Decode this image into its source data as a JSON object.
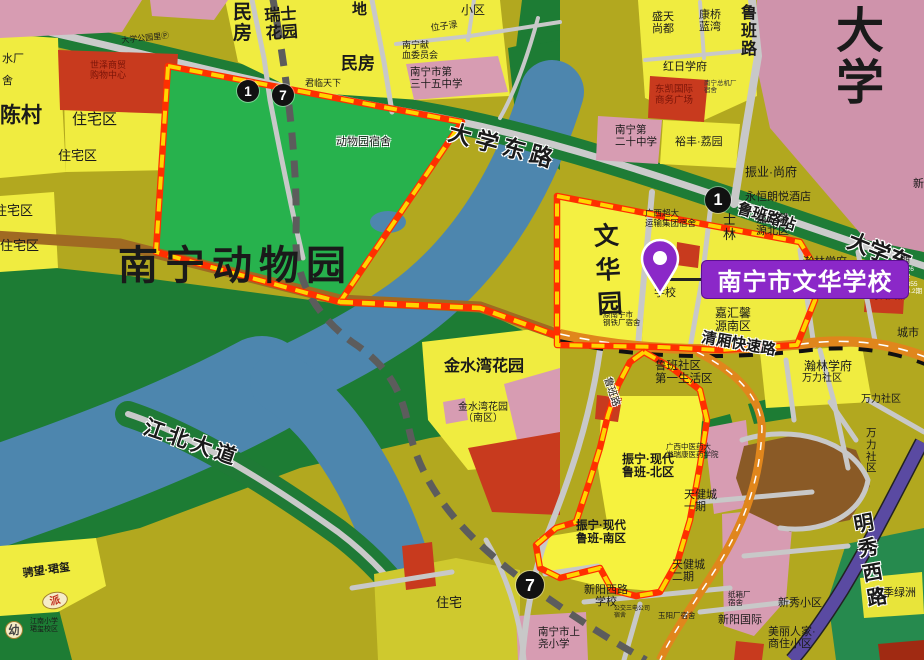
{
  "map": {
    "callout": {
      "text": "南宁市文华学校"
    },
    "colors": {
      "highlight_line": "#ff2f00",
      "highlight_dash": "#ffd400",
      "callout_purple": "#8b28c8",
      "zoo_green": "#27b24d",
      "river_blue": "#4d86ae",
      "expressway_orange": "#e0861c",
      "metro_gray": "#5c5c5c",
      "campus_pink": "#cf93ab",
      "block_yellow": "#f0ec40",
      "base_olive": "#b2a81f",
      "vegetation_green": "#1d7c34",
      "purple_road": "#5a4aa2"
    },
    "route_markers": [
      {
        "t": "1",
        "x": 248,
        "y": 91,
        "r": 11
      },
      {
        "t": "7",
        "x": 283,
        "y": 95,
        "r": 11
      },
      {
        "t": "1",
        "x": 718,
        "y": 200,
        "r": 13
      },
      {
        "t": "7",
        "x": 530,
        "y": 585,
        "r": 14
      }
    ],
    "badges": [
      {
        "t": "派",
        "x": 42,
        "y": 592,
        "w": 24,
        "h": 15,
        "fg": "#c23020",
        "rot": -12
      },
      {
        "t": "幼",
        "x": 5,
        "y": 621,
        "w": 16,
        "h": 16,
        "fg": "#444444",
        "rot": 0
      }
    ],
    "labels": [
      {
        "n": "minfang-vertical",
        "t": "民\n房",
        "x": 233,
        "y": 2,
        "s": 19,
        "b": 1
      },
      {
        "n": "ruishi-huayuan",
        "t": "瑞士\n花园",
        "x": 264,
        "y": 8,
        "s": 16,
        "b": 1,
        "r": -4
      },
      {
        "n": "di",
        "t": "地",
        "x": 352,
        "y": 2,
        "s": 15,
        "b": 1
      },
      {
        "n": "xiaoqu",
        "t": "小区",
        "x": 461,
        "y": 4,
        "s": 12
      },
      {
        "n": "minfang",
        "t": "民房",
        "x": 341,
        "y": 54,
        "s": 17,
        "b": 1
      },
      {
        "n": "weizilu-street",
        "t": "位子渌",
        "x": 430,
        "y": 23,
        "s": 9,
        "r": -8
      },
      {
        "n": "blood-committee",
        "t": "南宁献\n血委员会",
        "x": 402,
        "y": 40,
        "s": 9
      },
      {
        "n": "no35-middle-school",
        "t": "南宁市第\n三十五中学",
        "x": 410,
        "y": 67,
        "s": 10.5
      },
      {
        "n": "junlin-tianxia",
        "t": "君临天下",
        "x": 305,
        "y": 78,
        "s": 9
      },
      {
        "n": "daxue-park-p",
        "t": "大学公园里Ⓟ",
        "x": 121,
        "y": 37,
        "s": 8,
        "r": -6
      },
      {
        "n": "shuichang",
        "t": "水厂",
        "x": 2,
        "y": 53,
        "s": 11
      },
      {
        "n": "she",
        "t": "舍",
        "x": 2,
        "y": 75,
        "s": 11
      },
      {
        "n": "shopping-center",
        "t": "世泽商贸\n购物中心",
        "x": 90,
        "y": 60,
        "s": 9,
        "c": "#7a1408"
      },
      {
        "n": "chencun",
        "t": "陈村",
        "x": 0,
        "y": 104,
        "s": 21,
        "b": 1
      },
      {
        "n": "zhuzhaiqu-1",
        "t": "住宅区",
        "x": 72,
        "y": 112,
        "s": 15
      },
      {
        "n": "zhuzhaiqu-2",
        "t": "住宅区",
        "x": 58,
        "y": 149,
        "s": 13
      },
      {
        "n": "zhuzhaiqu-3",
        "t": "住宅区",
        "x": -6,
        "y": 204,
        "s": 13
      },
      {
        "n": "zhuzhaiqu-4",
        "t": "住宅区",
        "x": 0,
        "y": 239,
        "s": 13
      },
      {
        "n": "lubanlu-vertical",
        "t": "鲁\n班\n路",
        "x": 741,
        "y": 5,
        "s": 16,
        "b": 1
      },
      {
        "n": "shengtian-shangdu",
        "t": "盛天\n尚都",
        "x": 652,
        "y": 11,
        "s": 11
      },
      {
        "n": "kangqiao-lanwan",
        "t": "康桥\n蓝湾",
        "x": 699,
        "y": 9,
        "s": 11
      },
      {
        "n": "daxue-big",
        "t": "大\n学",
        "x": 836,
        "y": 6,
        "s": 48,
        "b": 1,
        "lh": 1.08
      },
      {
        "n": "hongri-xuefu",
        "t": "红日学府",
        "x": 663,
        "y": 61,
        "s": 11
      },
      {
        "n": "dongkai-plaza",
        "t": "东凯国际\n商务广场",
        "x": 655,
        "y": 85,
        "s": 9.5,
        "c": "#7a1408"
      },
      {
        "n": "zongjichang-sushe",
        "t": "南宁总机厂\n宿舍",
        "x": 704,
        "y": 80,
        "s": 6.5,
        "c": "#333333"
      },
      {
        "n": "no20-middle-school",
        "t": "南宁第\n二十中学",
        "x": 615,
        "y": 125,
        "s": 10.5
      },
      {
        "n": "yufeng-liyuan",
        "t": "裕丰·荔园",
        "x": 675,
        "y": 136,
        "s": 11
      },
      {
        "n": "zhenye-shangfu",
        "t": "振业·尚府",
        "x": 745,
        "y": 166,
        "s": 12
      },
      {
        "n": "yongheng-hotel",
        "t": "永恒朗悦酒店",
        "x": 745,
        "y": 191,
        "s": 11
      },
      {
        "n": "lubanlu-station",
        "t": "鲁班路站",
        "x": 740,
        "y": 201,
        "s": 15,
        "b": 1,
        "r": 17,
        "h": 1
      },
      {
        "n": "daxuedonglu-road",
        "t": "大学东路",
        "x": 452,
        "y": 120,
        "s": 23,
        "b": 1,
        "r": 15,
        "h": 1,
        "ls": 5
      },
      {
        "n": "daxuedong-right",
        "t": "大学东",
        "x": 853,
        "y": 229,
        "s": 22,
        "b": 1,
        "r": 22,
        "h": 1
      },
      {
        "n": "zoo-dorm",
        "t": "动物园宿舍",
        "x": 336,
        "y": 136,
        "s": 11,
        "h": 1
      },
      {
        "n": "nanning-zoo",
        "t": "南宁动物园",
        "x": 118,
        "y": 244,
        "s": 40,
        "b": 1,
        "ls": 7
      },
      {
        "n": "wenhuayuan-vertical",
        "t": "文\n华\n园",
        "x": 593,
        "y": 221,
        "s": 25,
        "b": 1,
        "lh": 1.35,
        "r": -3
      },
      {
        "n": "chaoda-dorm",
        "t": "广西超大\n运输集团宿舍",
        "x": 645,
        "y": 209,
        "s": 8.5
      },
      {
        "n": "xuexiao",
        "t": "学校",
        "x": 654,
        "y": 287,
        "s": 11
      },
      {
        "n": "gangtiechang-dorm",
        "t": "原南宁市\n钢铁厂宿舍",
        "x": 603,
        "y": 311,
        "s": 7.5
      },
      {
        "n": "shilin-vertical",
        "t": "士\n林",
        "x": 723,
        "y": 213,
        "s": 13
      },
      {
        "n": "jiahuixin-north",
        "t": "嘉汇馨\n源北区",
        "x": 756,
        "y": 213,
        "s": 11
      },
      {
        "n": "jiahuixin-south",
        "t": "嘉汇馨\n源南区",
        "x": 715,
        "y": 307,
        "s": 12
      },
      {
        "n": "hanlin-xuefu-1",
        "t": "瀚林学府",
        "x": 803,
        "y": 256,
        "s": 11
      },
      {
        "n": "qi",
        "t": "期",
        "x": 900,
        "y": 255,
        "s": 10
      },
      {
        "n": "small-numbers",
        "t": "626\n12\n1355\n64.2期",
        "x": 903,
        "y": 266,
        "s": 6.5,
        "c": "#ffffff"
      },
      {
        "n": "shidai-tianjiao",
        "t": "时代天骄",
        "x": 870,
        "y": 291,
        "s": 9,
        "c": "#7a1408"
      },
      {
        "n": "chengshi",
        "t": "城市",
        "x": 897,
        "y": 327,
        "s": 11
      },
      {
        "n": "qingxiang-expressway",
        "t": "清厢快速路",
        "x": 703,
        "y": 330,
        "s": 15,
        "b": 1,
        "r": 10,
        "h": 1
      },
      {
        "n": "hanlin-xuefu-2",
        "t": "瀚林学府",
        "x": 804,
        "y": 360,
        "s": 12
      },
      {
        "n": "wanli-shequ-1",
        "t": "万力社区",
        "x": 802,
        "y": 373,
        "s": 10
      },
      {
        "n": "wanli-shequ-2",
        "t": "万力社区",
        "x": 861,
        "y": 394,
        "s": 10
      },
      {
        "n": "wanli-shequ-vertical",
        "t": "万\n力\n社\n区",
        "x": 866,
        "y": 428,
        "s": 10.5
      },
      {
        "n": "luban-shequ",
        "t": "鲁班社区\n第一生活区",
        "x": 655,
        "y": 360,
        "s": 11.5
      },
      {
        "n": "lubanlu-south",
        "t": "鲁班路",
        "x": 612,
        "y": 376,
        "s": 10,
        "r": 72,
        "h": 1
      },
      {
        "n": "zhenning-north",
        "t": "振宁·现代\n鲁班-北区",
        "x": 622,
        "y": 453,
        "s": 12,
        "b": 1
      },
      {
        "n": "zhongyiyao-college",
        "t": "广西中医药大\n学瑞康医药学院",
        "x": 666,
        "y": 443,
        "s": 7.5
      },
      {
        "n": "tianjiancheng-1",
        "t": "天健城\n一期",
        "x": 684,
        "y": 489,
        "s": 11
      },
      {
        "n": "zhenning-south",
        "t": "振宁·现代\n鲁班-南区",
        "x": 576,
        "y": 520,
        "s": 11.5,
        "b": 1
      },
      {
        "n": "tianjiancheng-2",
        "t": "天健城\n二期",
        "x": 672,
        "y": 559,
        "s": 11
      },
      {
        "n": "mingxiuxilu-road",
        "t": "明\n秀\n西\n路",
        "x": 852,
        "y": 514,
        "s": 20,
        "b": 1,
        "r": -10,
        "h": 1,
        "lh": 1.25
      },
      {
        "n": "siji-lvzhou",
        "t": "四季绿洲",
        "x": 872,
        "y": 587,
        "s": 11
      },
      {
        "n": "xinxiu-xiaoqu",
        "t": "新秀小区",
        "x": 778,
        "y": 597,
        "s": 11
      },
      {
        "n": "zhixiangchang-dorm",
        "t": "纸箱厂\n宿舍",
        "x": 728,
        "y": 591,
        "s": 7.5
      },
      {
        "n": "yuyangchang-dorm",
        "t": "玉阳厂宿舍",
        "x": 658,
        "y": 612,
        "s": 7.5
      },
      {
        "n": "xinyang-guoji",
        "t": "新阳国际",
        "x": 718,
        "y": 614,
        "s": 11
      },
      {
        "n": "meili-renjia",
        "t": "美丽人家·\n商住小区",
        "x": 768,
        "y": 626,
        "s": 11
      },
      {
        "n": "xinyangxilu-school",
        "t": "新阳西路\n学校",
        "x": 584,
        "y": 584,
        "s": 11,
        "ta": "center"
      },
      {
        "n": "gongjiao-dorm",
        "t": "公交三电公司\n宿舍",
        "x": 614,
        "y": 606,
        "s": 6
      },
      {
        "n": "shangyao-primary",
        "t": "南宁市上\n尧小学",
        "x": 538,
        "y": 627,
        "s": 10.5
      },
      {
        "n": "zhuzhai",
        "t": "住宅",
        "x": 436,
        "y": 596,
        "s": 13
      },
      {
        "n": "chengwang-junxi",
        "t": "骋望·珺玺",
        "x": 22,
        "y": 568,
        "s": 11,
        "r": -8,
        "b": 1
      },
      {
        "n": "jiangnan-primary",
        "t": "江南小学\n珺玺校区",
        "x": 30,
        "y": 618,
        "s": 7
      },
      {
        "n": "jiangbeidadao-road",
        "t": "江北大道",
        "x": 148,
        "y": 416,
        "s": 21,
        "b": 1,
        "r": 19,
        "h": 1,
        "ls": 4
      },
      {
        "n": "jinshuiwan-big",
        "t": "金水湾花园",
        "x": 444,
        "y": 358,
        "s": 16,
        "b": 1
      },
      {
        "n": "jinshuiwan-south",
        "t": "金水湾花园\n（南区）",
        "x": 458,
        "y": 402,
        "s": 10,
        "ta": "center"
      },
      {
        "n": "xin-right-edge",
        "t": "新",
        "x": 913,
        "y": 178,
        "s": 11
      }
    ]
  }
}
